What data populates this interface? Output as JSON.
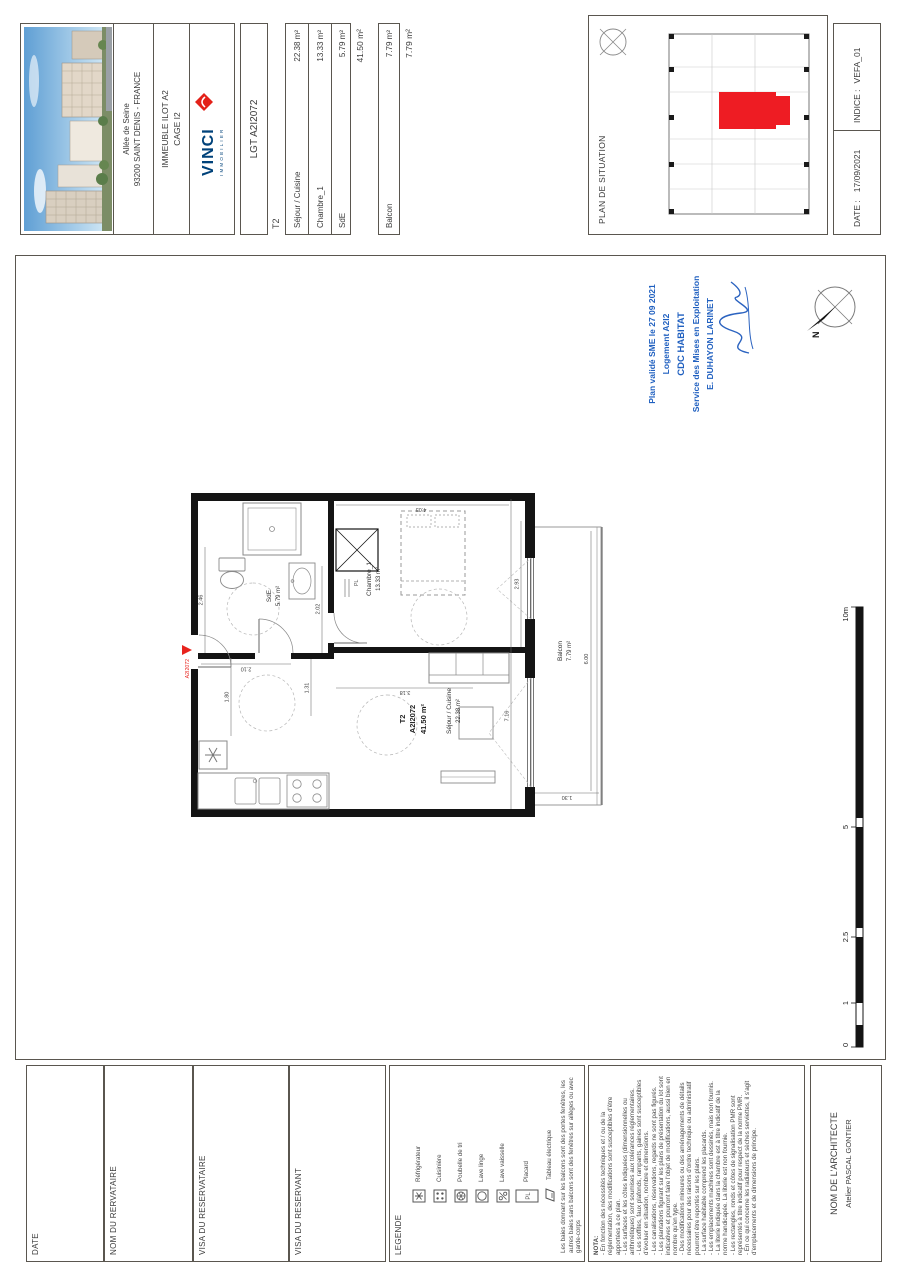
{
  "header": {
    "address_line1": "Allée de Seine",
    "address_line2": "93200 SAINT DENIS - FRANCE",
    "building": "IMMEUBLE ILOT  A2",
    "cage": "CAGE I2",
    "brand": "VINCI",
    "brand_sub": "IMMOBILIER"
  },
  "areas": {
    "lot": "LGT A2I2072",
    "type": "T2",
    "rows": [
      {
        "label": "Séjour / Cuisine",
        "value": "22.38 m²"
      },
      {
        "label": "Chambre_1",
        "value": "13.33 m²"
      },
      {
        "label": "SdE",
        "value": "5.79 m²"
      }
    ],
    "total": "41.50 m²",
    "balcon_label": "Balcon",
    "balcon_value": "7.79 m²",
    "balcon_total": "7.79 m²"
  },
  "situation": {
    "title": "PLAN DE SITUATION"
  },
  "revision": {
    "date_label": "DATE :",
    "date_value": "17/09/2021",
    "indice_label": "INDICE :",
    "indice_value": "VEFA_01"
  },
  "stamp": {
    "lines": [
      "Plan validé SME le 27 09 2021",
      "Logement A2I2",
      "CDC HABITAT",
      "Service des Mises en Exploitation",
      "E. DUHAYON LARINET"
    ]
  },
  "plan": {
    "unit_type": "T2",
    "unit_code": "A2I2072",
    "unit_area": "41.50 m²",
    "sejour_name": "Séjour / Cuisine",
    "sejour_area": "22.38 m²",
    "chambre_name": "Chambre_1",
    "chambre_area": "13.33 m²",
    "sde_name": "SdE",
    "sde_area": "5.79 m²",
    "balcon_name": "Balcon",
    "balcon_area": "7.79 m²",
    "entry_code": "A2I2072",
    "placard": "PL",
    "north": "N",
    "dims": {
      "sde_top": "2.46",
      "sde_bottom": "2.02",
      "entry": "2.10",
      "hall": "1.31",
      "kitchen": "1.80",
      "total_width": "7.16",
      "sejour_height": "3.18",
      "chambre_width": "2.93",
      "chambre_height": "4.03",
      "balcon_length": "6.00",
      "balcon_depth": "1.30"
    }
  },
  "scalebar": {
    "labels": [
      "0",
      "1",
      "2.5",
      "5",
      "10m"
    ]
  },
  "footer": {
    "date": "DATE",
    "nom_reservataire": "NOM DU RERVATAIRE",
    "visa_reservataire": "VISA DU RESERVATAIRE",
    "visa_reservant": "VISA DU RESERVANT",
    "legend": {
      "title": "LEGENDE",
      "items": [
        {
          "label": "Réfrigérateur"
        },
        {
          "label": "Cuisinière"
        },
        {
          "label": "Poubelle de tri"
        },
        {
          "label": "Lave linge"
        },
        {
          "label": "Lave vaisselle"
        },
        {
          "label": "Placard"
        },
        {
          "label": "Tableau électrique"
        }
      ],
      "note": "Les baies donnant sur les balcons sont des portes fenêtres, les autres baies sans balcons sont des fenêtres sur allèges ou avec garde-corps"
    },
    "nota": {
      "title": "NOTA:",
      "lines": [
        "- En fonction des nécessités techniques et / ou de la réglementation, des modifications sont susceptibles d'être apportées à ce plan.",
        "- Les surfaces et les côtes indiquées (dimensionnelles ou arithmétiques) sont soumises aux tolérances réglementaires.",
        "- Les soffites, faux plafonds, rampants, gaines sont susceptibles d'évoluer en situation, nombre et dimensions.",
        "- Les canalisations, réservations, regards ne sont pas figurés.",
        "- Les plantations figurant sur les plans de présentation du lot sont indicatives et pourront faire l'objet de modifications, aussi bien en nombre qu'en type.",
        "- Des modifications mineures ou des aménagements de détails nécessaires pour des raisons d'ordre technique ou administratif pourront être reportés sur les plans.",
        "- La surface habitable comprend les placards.",
        "- Les emplacements machines sont dessinés, mais non fournis.",
        "- La literie indiquée dans la chambre est à titre indicatif de la norme handicapée. La literie est non fournie.",
        "- Les rectangles, ronds et côtes de signalisation PMR sont représentés à titre indicatif pour respect de la norme PMR.",
        "- En ce qui concerne les radiateurs et sèches serviettes, il s'agit d'emplacements et de dimensions de principe."
      ]
    },
    "architect_label": "NOM DE L'ARCHITECTE",
    "architect_name": "Atelier PASCAL GONTIER"
  }
}
